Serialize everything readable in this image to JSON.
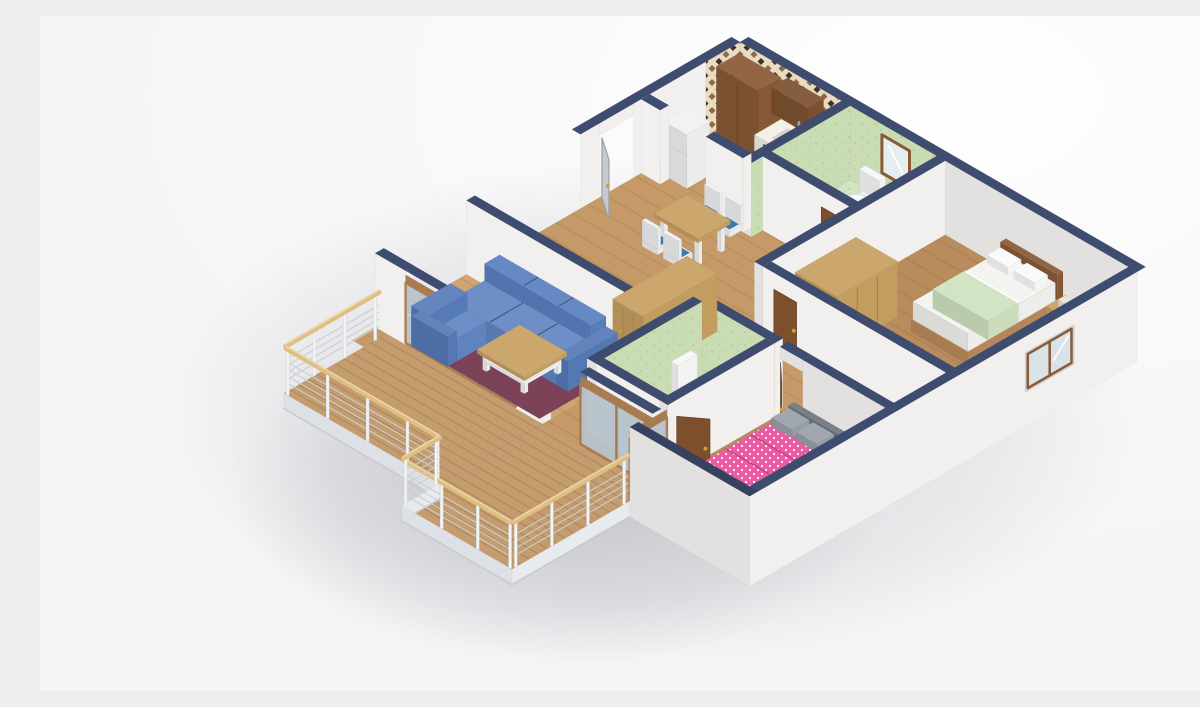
{
  "scene": {
    "type": "3d-floorplan-render",
    "view": "isometric cutaway apartment seen from above",
    "rooms": [
      {
        "id": "kitchen",
        "label": "Kitchen",
        "floor": "wood",
        "walls": "cream-and-brown checkered tile backsplash",
        "furniture": [
          "tall wooden cabinet",
          "wall cabinet",
          "counter with sink, faucet and cooktop",
          "oven",
          "refrigerator"
        ]
      },
      {
        "id": "hallway",
        "label": "Hallway",
        "floor": "wood",
        "furniture": [
          "entrance door (open)",
          "dining table",
          "four chairs with blue plaid cushions"
        ]
      },
      {
        "id": "bathroom-1",
        "label": "Bathroom 1",
        "floor": "green tile",
        "walls": "green tile",
        "furniture": [
          "toilet",
          "washbasin",
          "framed mirror",
          "brown door"
        ]
      },
      {
        "id": "bedroom-1",
        "label": "Bedroom 1",
        "floor": "wood",
        "furniture": [
          "double bed with white sheets and green blanket",
          "wooden headboard",
          "wardrobe",
          "bedside table",
          "window in exterior wall",
          "brown door"
        ]
      },
      {
        "id": "living-room",
        "label": "Living room",
        "floor": "wood",
        "furniture": [
          "blue L-shaped sectional sofa",
          "maroon rug",
          "wooden coffee table with white shelf",
          "sliding glass doors to balcony"
        ]
      },
      {
        "id": "wardrobe-nook",
        "label": "Hall wardrobe",
        "furniture": [
          "three-door wooden wardrobe"
        ]
      },
      {
        "id": "bathroom-2",
        "label": "Bathroom 2",
        "floor": "green tile",
        "walls": "green tile",
        "furniture": [
          "toilet",
          "pedestal sink",
          "brown door (open)"
        ]
      },
      {
        "id": "bedroom-2",
        "label": "Bedroom 2",
        "floor": "wood",
        "furniture": [
          "bed with pink polka-dot duvet",
          "gray pillows",
          "gray headboard",
          "maroon rug",
          "sliding doors to balcony"
        ]
      },
      {
        "id": "balcony-upper",
        "label": "Balcony 1",
        "floor": "wood deck",
        "furniture": [
          "white posts",
          "cable railing",
          "wooden handrail"
        ]
      },
      {
        "id": "balcony-lower",
        "label": "Balcony 2",
        "floor": "wood deck",
        "furniture": [
          "white posts",
          "cable railing",
          "wooden handrail"
        ]
      }
    ]
  },
  "colors": {
    "background": "#f5f5f7",
    "highlight": "#ffffff",
    "shadow": "#494957",
    "wallCap": "#3e4c70",
    "wallCapDark": "#36425f",
    "wallFaceLight": "#f1f0ee",
    "wallFaceMid": "#e2e1e0",
    "wallFaceDark": "#d2d3d6",
    "floorWoodHall": "#c59a68",
    "floorWoodLiving": "#cfa673",
    "floorWoodBedroom": "#b88c5c",
    "deckWood": "#c49c6e",
    "slabEdge": "#e8ebee",
    "slabEdgeDark": "#dde1e5",
    "tileGreen": "#c9dcb4",
    "tileGreenFloor": "#d4e4c2",
    "tileDot": "#afc797",
    "checkerCream": "#e9dcc2",
    "checkerDark": "#42332a",
    "checkerBrown": "#8a6848",
    "sofaBlue": "#5b80c0",
    "rugMaroon": "#7c4257",
    "rugMaroon2": "#774054",
    "woodFurniture": "#c79f62",
    "woodDark": "#8a5a36",
    "woodDarker": "#7d5130",
    "doorBrown": "#7d4f2c",
    "doorGray": "#c6cad0",
    "handleGold": "#c9a23a",
    "white": "#f7f8f7",
    "whiteSoft": "#eef0ee",
    "applianceDark": "#3a3733",
    "glass": "#b7c3cb",
    "glassLight": "#e6edf0",
    "bedPink": "#e94f9d",
    "pillowGray": "#99a0a9",
    "headboardGray": "#6e7681",
    "bedGreen": "#cfe2c0",
    "railPost": "#f2f4f5",
    "railWood": "#dfbe83",
    "cable": "#c9ced3",
    "frameWood": "#a97c4f"
  }
}
